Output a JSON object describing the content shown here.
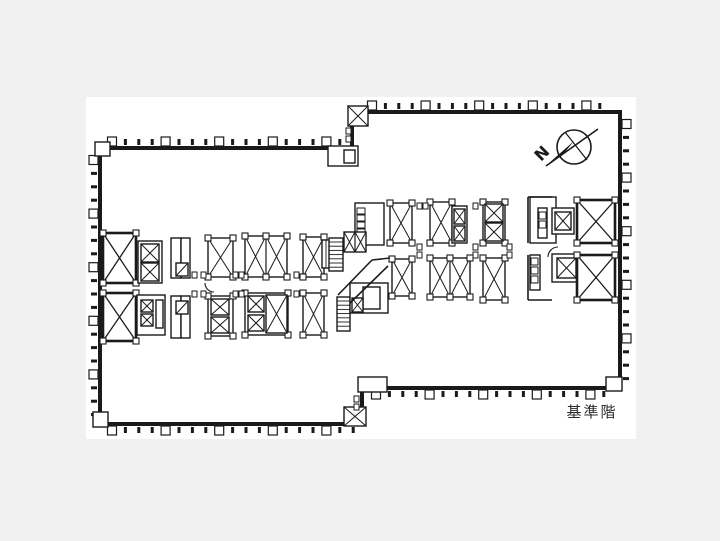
{
  "colors": {
    "bg": "#f1f1f1",
    "sheet": "#ffffff",
    "line": "#1a1a1a",
    "label": "#2a2a2a"
  },
  "sheet": {
    "x": 86,
    "y": 97,
    "w": 550,
    "h": 342
  },
  "labels": {
    "floor": "基準階",
    "floor_x": 592,
    "floor_y": 417,
    "floor_size": 15
  },
  "north_arrow": {
    "letter": "N",
    "cx": 574,
    "cy": 147,
    "r": 17,
    "needle": [
      546,
      166,
      598,
      129
    ],
    "cross": [
      565,
      132,
      587,
      160
    ],
    "head": "549,163 574,141 565,152",
    "lx": 541,
    "ly": 162,
    "rot": -45
  },
  "floor_plan": {
    "outline": "100,148 352,148 352,112 620,112 620,388 362,388 362,424 100,424",
    "mullions": [
      [
        112,
        146,
        348,
        146,
        "up"
      ],
      [
        372,
        110,
        612,
        110,
        "up"
      ],
      [
        98,
        160,
        98,
        418,
        "left"
      ],
      [
        622,
        124,
        622,
        382,
        "right"
      ],
      [
        112,
        426,
        354,
        426,
        "down"
      ],
      [
        376,
        390,
        608,
        390,
        "down"
      ]
    ],
    "boxes": [
      [
        "xboxb",
        103,
        233,
        33,
        50,
        1
      ],
      [
        "xboxb",
        103,
        293,
        33,
        48,
        1
      ],
      [
        "room",
        138,
        241,
        24,
        42,
        0
      ],
      [
        "xbox",
        141,
        244,
        18,
        18,
        0
      ],
      [
        "xbox",
        141,
        263,
        18,
        18,
        0
      ],
      [
        "room",
        171,
        238,
        10,
        40,
        0
      ],
      [
        "room",
        181,
        238,
        9,
        40,
        0
      ],
      [
        "dbox",
        176,
        263,
        12,
        13,
        0
      ],
      [
        "room",
        137,
        295,
        28,
        40,
        0
      ],
      [
        "xbox",
        141,
        300,
        12,
        12,
        0
      ],
      [
        "xbox",
        141,
        314,
        12,
        12,
        0
      ],
      [
        "room",
        156,
        300,
        7,
        28,
        0
      ],
      [
        "room",
        171,
        296,
        10,
        42,
        0
      ],
      [
        "room",
        181,
        296,
        9,
        42,
        0
      ],
      [
        "dbox",
        176,
        301,
        12,
        13,
        0
      ],
      [
        "xbox",
        208,
        238,
        25,
        39,
        1
      ],
      [
        "xbox2",
        245,
        236,
        42,
        41,
        1
      ],
      [
        "xbox",
        303,
        237,
        21,
        40,
        1
      ],
      [
        "stairv",
        322,
        240,
        18,
        28,
        0
      ],
      [
        "room",
        208,
        296,
        25,
        40,
        1
      ],
      [
        "xbox",
        211,
        299,
        18,
        16,
        0
      ],
      [
        "xbox",
        211,
        317,
        18,
        16,
        0
      ],
      [
        "room",
        245,
        293,
        43,
        42,
        1
      ],
      [
        "xbox",
        248,
        296,
        16,
        16,
        0
      ],
      [
        "xbox",
        248,
        315,
        16,
        16,
        0
      ],
      [
        "xbox",
        266,
        295,
        21,
        38,
        0
      ],
      [
        "xbox",
        303,
        293,
        21,
        42,
        1
      ],
      [
        "room",
        355,
        203,
        29,
        42,
        0
      ],
      [
        "sq",
        357,
        208,
        8,
        6,
        0
      ],
      [
        "sq",
        357,
        215,
        8,
        6,
        0
      ],
      [
        "sq",
        357,
        222,
        8,
        6,
        0
      ],
      [
        "sq",
        357,
        229,
        8,
        6,
        0
      ],
      [
        "sq",
        357,
        236,
        8,
        6,
        0
      ],
      [
        "xbox2",
        344,
        232,
        22,
        20,
        0
      ],
      [
        "stairh",
        329,
        238,
        14,
        33,
        0
      ],
      [
        "stairh",
        337,
        297,
        13,
        34,
        0
      ],
      [
        "room",
        350,
        283,
        38,
        30,
        0
      ],
      [
        "room",
        363,
        287,
        17,
        22,
        0
      ],
      [
        "xbox",
        352,
        298,
        11,
        14,
        0
      ],
      [
        "xbox",
        390,
        203,
        22,
        40,
        1
      ],
      [
        "xbox",
        430,
        202,
        22,
        41,
        1
      ],
      [
        "room",
        452,
        206,
        15,
        37,
        0
      ],
      [
        "xbox",
        454,
        209,
        11,
        15,
        0
      ],
      [
        "xbox",
        454,
        226,
        11,
        15,
        0
      ],
      [
        "room",
        483,
        202,
        22,
        41,
        1
      ],
      [
        "xbox",
        485,
        204,
        18,
        18,
        0
      ],
      [
        "xbox",
        485,
        223,
        18,
        18,
        0
      ],
      [
        "room",
        530,
        197,
        26,
        46,
        0
      ],
      [
        "room",
        538,
        208,
        9,
        30,
        0
      ],
      [
        "sq",
        539,
        212,
        7,
        7,
        0
      ],
      [
        "sq",
        539,
        221,
        7,
        7,
        0
      ],
      [
        "room",
        552,
        208,
        22,
        26,
        0
      ],
      [
        "xbox",
        555,
        212,
        16,
        18,
        0
      ],
      [
        "xboxb",
        577,
        200,
        38,
        43,
        1
      ],
      [
        "xbox",
        392,
        259,
        20,
        37,
        1
      ],
      [
        "xbox2",
        430,
        258,
        40,
        39,
        1
      ],
      [
        "xbox",
        483,
        258,
        22,
        42,
        1
      ],
      [
        "room",
        530,
        255,
        10,
        35,
        0
      ],
      [
        "sq",
        531,
        258,
        7,
        7,
        0
      ],
      [
        "sq",
        531,
        267,
        7,
        7,
        0
      ],
      [
        "sq",
        531,
        276,
        7,
        7,
        0
      ],
      [
        "room",
        552,
        254,
        28,
        28,
        0
      ],
      [
        "xbox",
        557,
        258,
        19,
        20,
        0
      ],
      [
        "xboxb",
        577,
        255,
        38,
        45,
        1
      ],
      [
        "xbox",
        348,
        106,
        20,
        20,
        0
      ],
      [
        "xbox",
        344,
        407,
        22,
        19,
        0
      ],
      [
        "room",
        328,
        146,
        30,
        20,
        0
      ],
      [
        "room",
        344,
        150,
        11,
        13,
        0
      ],
      [
        "room",
        358,
        377,
        29,
        15,
        0
      ],
      [
        "room",
        93,
        412,
        15,
        15,
        0
      ],
      [
        "room",
        95,
        142,
        15,
        14,
        0
      ],
      [
        "room",
        606,
        377,
        16,
        14,
        0
      ]
    ],
    "lines": [
      [
        338,
        295,
        372,
        260
      ],
      [
        350,
        303,
        388,
        266
      ],
      [
        372,
        260,
        390,
        258
      ],
      [
        528,
        197,
        528,
        243
      ],
      [
        528,
        255,
        528,
        300
      ],
      [
        528,
        197,
        552,
        197
      ],
      [
        528,
        300,
        552,
        300
      ]
    ],
    "paths": [
      "M548,257 A10,10 0 0 1 558,247",
      "M205,283 A9,9 0 0 0 214,292"
    ],
    "stubs": [
      [
        192,
        272
      ],
      [
        201,
        272
      ],
      [
        233,
        272
      ],
      [
        239,
        272
      ],
      [
        294,
        272
      ],
      [
        192,
        291
      ],
      [
        201,
        291
      ],
      [
        233,
        291
      ],
      [
        239,
        291
      ],
      [
        294,
        291
      ],
      [
        417,
        244
      ],
      [
        473,
        244
      ],
      [
        507,
        244
      ],
      [
        417,
        252
      ],
      [
        473,
        252
      ],
      [
        507,
        252
      ],
      [
        417,
        203
      ],
      [
        423,
        203
      ],
      [
        473,
        203
      ],
      [
        346,
        128
      ],
      [
        346,
        136
      ],
      [
        354,
        396
      ],
      [
        354,
        404
      ]
    ]
  }
}
